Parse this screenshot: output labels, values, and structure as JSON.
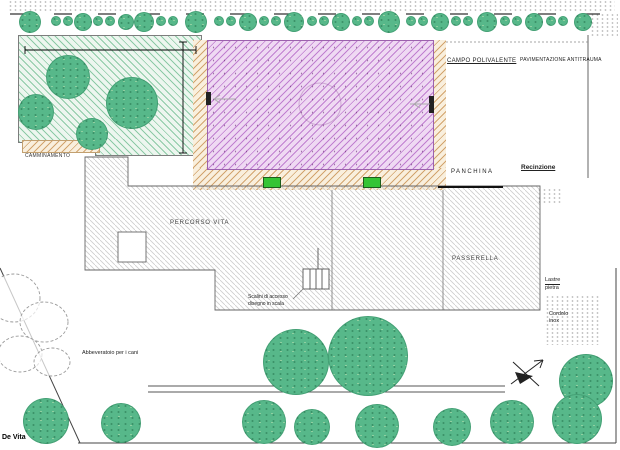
{
  "plan": {
    "labels": {
      "field": "CAMPO POLIVALENTE",
      "paving": "PAVIMENTAZIONE ANTITRAUMA",
      "bench": "PANCHINA",
      "fence": "Recinzione",
      "trail": "PERCORSO VITA",
      "walkway": "PASSERELLA",
      "path": "CAMMINAMENTO",
      "steps_note_line1": "Scalini di accesso",
      "steps_note_line2": "disegno in scala",
      "dog_fountain": "Abbeveratoio per i cani",
      "note_upper_line1": "Lastre",
      "note_upper_line2": "pietra",
      "note_lower_line1": "Cordolo",
      "note_lower_line2": "inox",
      "author": "De Vita"
    },
    "colors": {
      "tree_green": "#57b88a",
      "bench_green": "#35c435",
      "field_violet_bg": "#efd9f3",
      "field_violet_line": "#c07fd0",
      "grove_green_bg": "#edf6ef",
      "grove_green_line": "#8ccaa6",
      "tan_bg": "#f9efdd",
      "tan_line": "#d2a46e",
      "hatch_gray": "#cdcdcd",
      "line_dark": "#333333"
    },
    "trees": {
      "top_row": [
        [
          30,
          22,
          11
        ],
        [
          56,
          21,
          5
        ],
        [
          68,
          21,
          5
        ],
        [
          83,
          22,
          9
        ],
        [
          98,
          21,
          5
        ],
        [
          110,
          21,
          5
        ],
        [
          126,
          22,
          8
        ],
        [
          144,
          22,
          10
        ],
        [
          161,
          21,
          5
        ],
        [
          173,
          21,
          5
        ],
        [
          196,
          22,
          11
        ],
        [
          219,
          21,
          5
        ],
        [
          231,
          21,
          5
        ],
        [
          248,
          22,
          9
        ],
        [
          264,
          21,
          5
        ],
        [
          276,
          21,
          5
        ],
        [
          294,
          22,
          10
        ],
        [
          312,
          21,
          5
        ],
        [
          324,
          21,
          5
        ],
        [
          341,
          22,
          9
        ],
        [
          357,
          21,
          5
        ],
        [
          369,
          21,
          5
        ],
        [
          389,
          22,
          11
        ],
        [
          411,
          21,
          5
        ],
        [
          423,
          21,
          5
        ],
        [
          440,
          22,
          9
        ],
        [
          456,
          21,
          5
        ],
        [
          468,
          21,
          5
        ],
        [
          487,
          22,
          10
        ],
        [
          505,
          21,
          5
        ],
        [
          517,
          21,
          5
        ],
        [
          534,
          22,
          9
        ],
        [
          551,
          21,
          5
        ],
        [
          563,
          21,
          5
        ],
        [
          583,
          22,
          9
        ]
      ],
      "grove": [
        [
          68,
          77,
          22
        ],
        [
          132,
          103,
          26
        ],
        [
          36,
          112,
          18
        ],
        [
          92,
          134,
          16
        ]
      ],
      "bottom_large": [
        [
          296,
          362,
          33
        ],
        [
          368,
          356,
          40
        ],
        [
          586,
          381,
          27
        ]
      ],
      "bottom_row": [
        [
          46,
          421,
          23
        ],
        [
          121,
          423,
          20
        ],
        [
          264,
          422,
          22
        ],
        [
          312,
          427,
          18
        ],
        [
          377,
          426,
          22
        ],
        [
          452,
          427,
          19
        ],
        [
          512,
          422,
          22
        ],
        [
          577,
          419,
          25
        ]
      ]
    },
    "bushes": [
      [
        14,
        298,
        26,
        24
      ],
      [
        44,
        322,
        24,
        20
      ],
      [
        20,
        354,
        22,
        18
      ],
      [
        52,
        362,
        18,
        14
      ]
    ]
  }
}
